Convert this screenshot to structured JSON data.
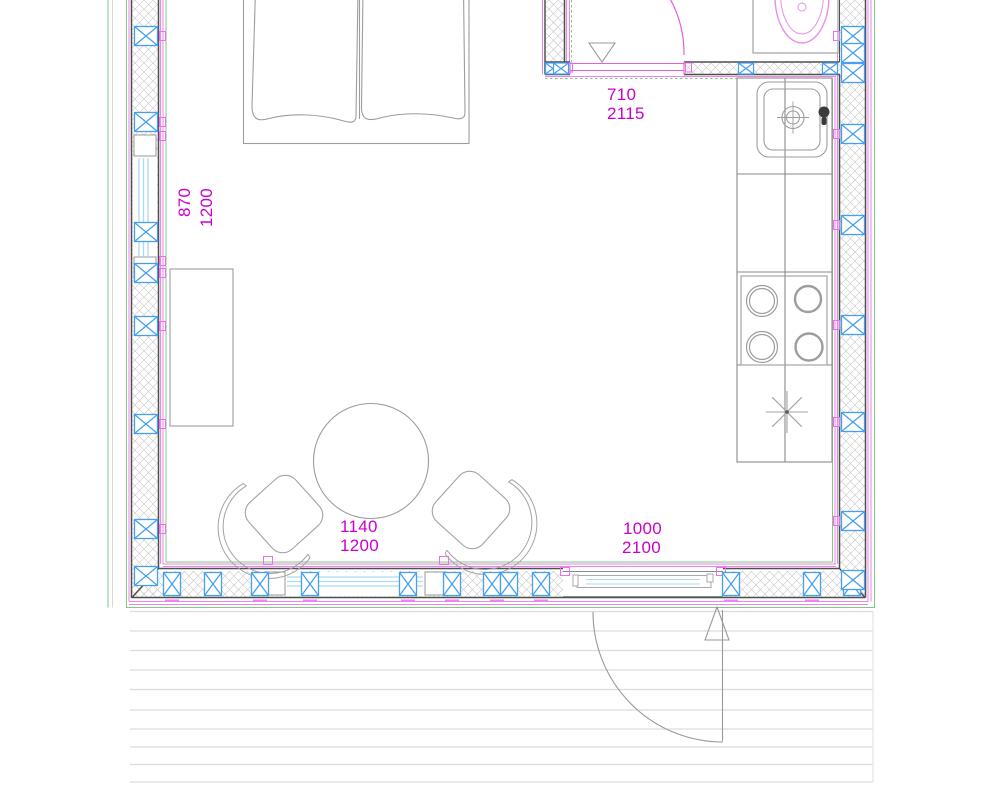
{
  "plan": {
    "type": "floor-plan",
    "labels": {
      "left_window": [
        "870",
        "1200"
      ],
      "bathroom_door": [
        "710",
        "2115"
      ],
      "bottom_window": [
        "1140",
        "1200"
      ],
      "entrance_door": [
        "1000",
        "2100"
      ]
    },
    "colors": {
      "dimension_text": "#cc00cc",
      "stud_marker_blue": "#46a0ef",
      "wall_accent_magenta": "#ee82ee",
      "boundary_green": "#7ccc7c",
      "glazing_blue": "#aed9f2",
      "fixture_magenta": "#e98fe9",
      "wall_outline": "#4f4f4f",
      "furniture_gray": "#9d9d9d",
      "hatch_gray": "#cfcfcf",
      "deck_board_gray": "#dcdcdc"
    },
    "fixtures": [
      "bed",
      "desk",
      "round-table",
      "chair-left",
      "chair-right",
      "kitchen-counter",
      "kitchen-sink",
      "faucet",
      "stove-4-burner",
      "light-symbol",
      "vanity-basin",
      "bathroom-door-swing",
      "entrance-door-swing",
      "deck-boards"
    ]
  }
}
